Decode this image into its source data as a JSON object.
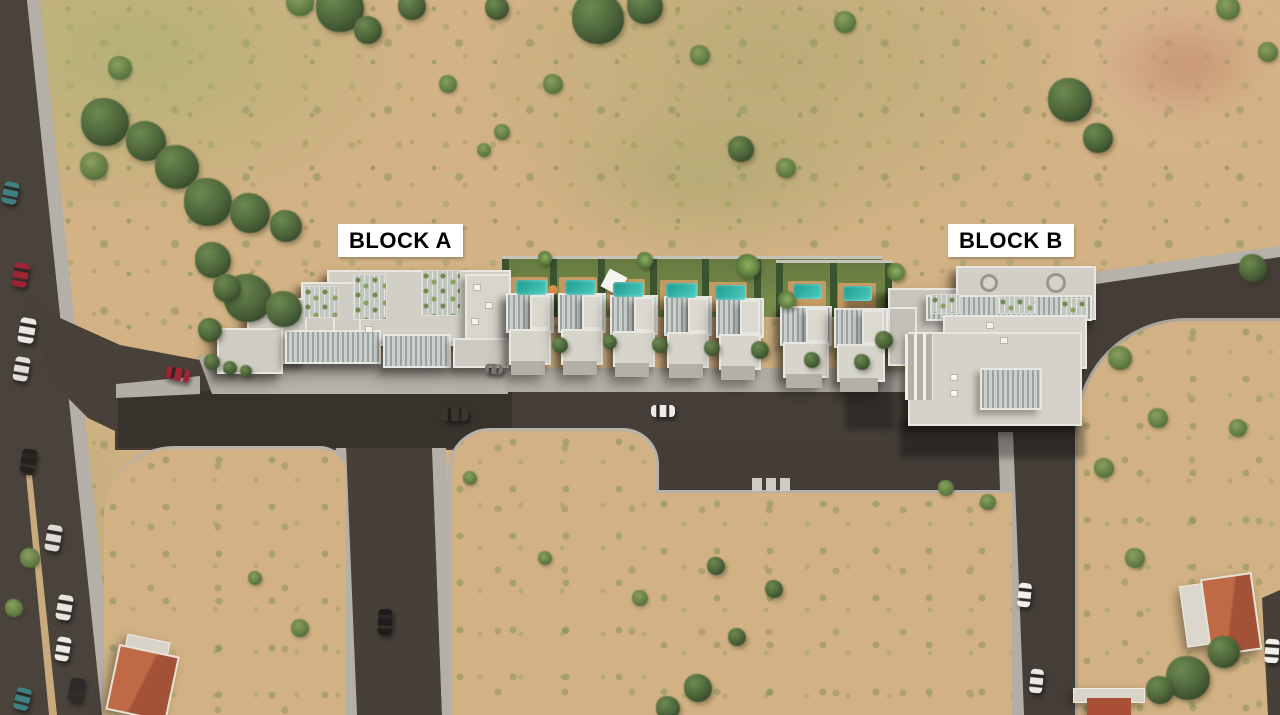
{
  "labels": {
    "block_a": "BLOCK A",
    "block_b": "BLOCK B"
  },
  "palette": {
    "terrain_tan": "#d3b385",
    "grass_green": "#7d9151",
    "tree_dark": "#41573a",
    "road": "#463f39",
    "sidewalk": "#b4afa7",
    "building": "#d2cfc6",
    "pool_teal": "#2aa89c",
    "deck_wood": "#c49a63",
    "hedge": "#3a5430",
    "red_roof": "#b35c3e",
    "label_bg": "#ffffff",
    "label_text": "#000000"
  },
  "pools": [
    {
      "x": 516,
      "y": 280,
      "w": 31,
      "h": 15
    },
    {
      "x": 565,
      "y": 280,
      "w": 31,
      "h": 15
    },
    {
      "x": 613,
      "y": 282,
      "w": 31,
      "h": 15
    },
    {
      "x": 666,
      "y": 283,
      "w": 31,
      "h": 15
    },
    {
      "x": 715,
      "y": 285,
      "w": 31,
      "h": 15
    },
    {
      "x": 793,
      "y": 284,
      "w": 29,
      "h": 15
    },
    {
      "x": 843,
      "y": 286,
      "w": 29,
      "h": 15
    }
  ],
  "cars": [
    {
      "x": 10,
      "y": 193,
      "w": 15,
      "h": 22,
      "rot": 12,
      "c": "#3e8182"
    },
    {
      "x": 20,
      "y": 275,
      "w": 15,
      "h": 24,
      "rot": 10,
      "c": "#a02433"
    },
    {
      "x": 27,
      "y": 330,
      "w": 16,
      "h": 25,
      "rot": 10,
      "c": "#e8e7e3"
    },
    {
      "x": 21,
      "y": 369,
      "w": 15,
      "h": 24,
      "rot": 10,
      "c": "#dfdeda"
    },
    {
      "x": 28,
      "y": 461,
      "w": 15,
      "h": 24,
      "rot": 10,
      "c": "#22211e"
    },
    {
      "x": 53,
      "y": 538,
      "w": 15,
      "h": 26,
      "rot": 10,
      "c": "#dcdbd7"
    },
    {
      "x": 64,
      "y": 607,
      "w": 15,
      "h": 25,
      "rot": 10,
      "c": "#e6e5e1"
    },
    {
      "x": 63,
      "y": 649,
      "w": 14,
      "h": 24,
      "rot": 10,
      "c": "#eceae6"
    },
    {
      "x": 76,
      "y": 690,
      "w": 15,
      "h": 24,
      "rot": 10,
      "c": "#2c2b29"
    },
    {
      "x": 22,
      "y": 699,
      "w": 15,
      "h": 22,
      "rot": 14,
      "c": "#3e8182"
    },
    {
      "x": 178,
      "y": 374,
      "w": 24,
      "h": 13,
      "rot": 12,
      "c": "#a02433"
    },
    {
      "x": 455,
      "y": 414,
      "w": 26,
      "h": 13,
      "rot": 0,
      "c": "#3a372f"
    },
    {
      "x": 663,
      "y": 411,
      "w": 24,
      "h": 12,
      "rot": 0,
      "c": "#edebe7"
    },
    {
      "x": 494,
      "y": 369,
      "w": 18,
      "h": 10,
      "rot": 4,
      "c": "#77756f"
    },
    {
      "x": 385,
      "y": 622,
      "w": 14,
      "h": 26,
      "rot": 3,
      "c": "#1e1d1b"
    },
    {
      "x": 1024,
      "y": 595,
      "w": 13,
      "h": 24,
      "rot": 6,
      "c": "#f0efec"
    },
    {
      "x": 1036,
      "y": 681,
      "w": 13,
      "h": 24,
      "rot": 6,
      "c": "#e9e8e4"
    },
    {
      "x": 1272,
      "y": 651,
      "w": 14,
      "h": 24,
      "rot": 4,
      "c": "#f0efec"
    }
  ],
  "trees": [
    {
      "x": 340,
      "y": 8,
      "r": 24,
      "t": 1
    },
    {
      "x": 368,
      "y": 30,
      "r": 14,
      "t": 1
    },
    {
      "x": 300,
      "y": 2,
      "r": 14,
      "t": 2
    },
    {
      "x": 412,
      "y": 6,
      "r": 14,
      "t": 1
    },
    {
      "x": 497,
      "y": 8,
      "r": 12,
      "t": 1
    },
    {
      "x": 598,
      "y": 18,
      "r": 26,
      "t": 1
    },
    {
      "x": 645,
      "y": 6,
      "r": 18,
      "t": 1
    },
    {
      "x": 700,
      "y": 55,
      "r": 10,
      "t": 2
    },
    {
      "x": 741,
      "y": 149,
      "r": 13,
      "t": 1
    },
    {
      "x": 786,
      "y": 168,
      "r": 10,
      "t": 2
    },
    {
      "x": 845,
      "y": 22,
      "r": 11,
      "t": 2
    },
    {
      "x": 1070,
      "y": 100,
      "r": 22,
      "t": 1
    },
    {
      "x": 1098,
      "y": 138,
      "r": 15,
      "t": 1
    },
    {
      "x": 1228,
      "y": 8,
      "r": 12,
      "t": 2
    },
    {
      "x": 1268,
      "y": 52,
      "r": 10,
      "t": 2
    },
    {
      "x": 1253,
      "y": 268,
      "r": 14,
      "t": 1
    },
    {
      "x": 105,
      "y": 122,
      "r": 24,
      "t": 1
    },
    {
      "x": 146,
      "y": 141,
      "r": 20,
      "t": 1
    },
    {
      "x": 177,
      "y": 167,
      "r": 22,
      "t": 1
    },
    {
      "x": 208,
      "y": 202,
      "r": 24,
      "t": 1
    },
    {
      "x": 250,
      "y": 213,
      "r": 20,
      "t": 1
    },
    {
      "x": 286,
      "y": 226,
      "r": 16,
      "t": 1
    },
    {
      "x": 94,
      "y": 166,
      "r": 14,
      "t": 2
    },
    {
      "x": 213,
      "y": 260,
      "r": 18,
      "t": 1
    },
    {
      "x": 248,
      "y": 298,
      "r": 24,
      "t": 1
    },
    {
      "x": 284,
      "y": 309,
      "r": 18,
      "t": 1
    },
    {
      "x": 227,
      "y": 288,
      "r": 14,
      "t": 1
    },
    {
      "x": 210,
      "y": 330,
      "r": 12,
      "t": 1
    },
    {
      "x": 120,
      "y": 68,
      "r": 12,
      "t": 2
    },
    {
      "x": 448,
      "y": 84,
      "r": 9,
      "t": 2
    },
    {
      "x": 553,
      "y": 84,
      "r": 10,
      "t": 2
    },
    {
      "x": 502,
      "y": 132,
      "r": 8,
      "t": 2
    },
    {
      "x": 484,
      "y": 150,
      "r": 7,
      "t": 2
    },
    {
      "x": 716,
      "y": 566,
      "r": 9,
      "t": 1
    },
    {
      "x": 774,
      "y": 589,
      "r": 9,
      "t": 1
    },
    {
      "x": 737,
      "y": 637,
      "r": 9,
      "t": 1
    },
    {
      "x": 698,
      "y": 688,
      "r": 14,
      "t": 1
    },
    {
      "x": 668,
      "y": 708,
      "r": 12,
      "t": 1
    },
    {
      "x": 640,
      "y": 598,
      "r": 8,
      "t": 2
    },
    {
      "x": 946,
      "y": 488,
      "r": 8,
      "t": 2
    },
    {
      "x": 988,
      "y": 502,
      "r": 8,
      "t": 2
    },
    {
      "x": 1120,
      "y": 358,
      "r": 12,
      "t": 2
    },
    {
      "x": 1158,
      "y": 418,
      "r": 10,
      "t": 2
    },
    {
      "x": 1104,
      "y": 468,
      "r": 10,
      "t": 2
    },
    {
      "x": 1238,
      "y": 428,
      "r": 9,
      "t": 2
    },
    {
      "x": 1188,
      "y": 678,
      "r": 22,
      "t": 1
    },
    {
      "x": 1224,
      "y": 652,
      "r": 16,
      "t": 1
    },
    {
      "x": 1160,
      "y": 690,
      "r": 14,
      "t": 1
    },
    {
      "x": 30,
      "y": 558,
      "r": 10,
      "t": 2
    },
    {
      "x": 14,
      "y": 608,
      "r": 9,
      "t": 2
    },
    {
      "x": 300,
      "y": 628,
      "r": 9,
      "t": 2
    },
    {
      "x": 255,
      "y": 578,
      "r": 7,
      "t": 2
    },
    {
      "x": 470,
      "y": 478,
      "r": 7,
      "t": 2
    },
    {
      "x": 545,
      "y": 558,
      "r": 7,
      "t": 2
    },
    {
      "x": 1135,
      "y": 558,
      "r": 10,
      "t": 2
    },
    {
      "x": 212,
      "y": 362,
      "r": 8,
      "t": 1
    },
    {
      "x": 230,
      "y": 368,
      "r": 7,
      "t": 1
    },
    {
      "x": 246,
      "y": 371,
      "r": 6,
      "t": 1
    },
    {
      "x": 560,
      "y": 345,
      "r": 8,
      "t": 1
    },
    {
      "x": 610,
      "y": 342,
      "r": 7,
      "t": 1
    },
    {
      "x": 660,
      "y": 345,
      "r": 8,
      "t": 1
    },
    {
      "x": 712,
      "y": 348,
      "r": 8,
      "t": 1
    },
    {
      "x": 760,
      "y": 350,
      "r": 9,
      "t": 1
    },
    {
      "x": 812,
      "y": 360,
      "r": 8,
      "t": 1
    },
    {
      "x": 862,
      "y": 362,
      "r": 8,
      "t": 1
    },
    {
      "x": 884,
      "y": 340,
      "r": 9,
      "t": 1
    },
    {
      "x": 748,
      "y": 266,
      "r": 12,
      "t": 3
    },
    {
      "x": 787,
      "y": 300,
      "r": 9,
      "t": 3
    },
    {
      "x": 645,
      "y": 260,
      "r": 8,
      "t": 3
    },
    {
      "x": 545,
      "y": 258,
      "r": 7,
      "t": 3
    },
    {
      "x": 896,
      "y": 272,
      "r": 9,
      "t": 3
    }
  ]
}
